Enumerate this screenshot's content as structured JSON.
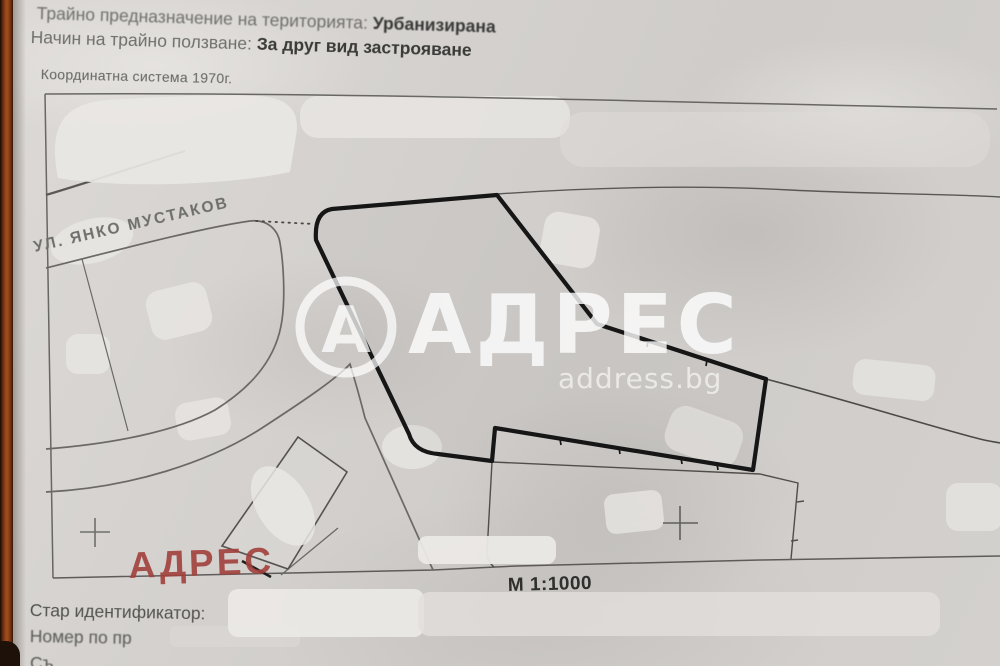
{
  "header": {
    "designation_label": "Трайно предназначение на територията:",
    "designation_value": "Урбанизирана",
    "usage_label": "Начин на трайно ползване:",
    "usage_value": "За друг вид застрояване"
  },
  "map": {
    "coordinate_system": "Координатна система 1970г.",
    "street_name": "УЛ. ЯНКО МУСТАКОВ",
    "scale_label": "М 1:1000",
    "red_stamp": "АДРЕС"
  },
  "watermark": {
    "logo_letter": "А",
    "brand": "АДРЕС",
    "domain": "address.bg"
  },
  "footer": {
    "old_identifier_label": "Стар идентификатор:",
    "previous_plan_label": "Номер по пр",
    "cut_off_text": "Съ"
  },
  "colors": {
    "paper": "#d4d1ce",
    "ink_dark": "#3a3a38",
    "ink_gray": "#6f6f6d",
    "parcel_outline": "#161616",
    "stamp_red": "#a2403c",
    "watermark_white": "#ffffff",
    "binding_strip_rust": "#a44e1e"
  }
}
